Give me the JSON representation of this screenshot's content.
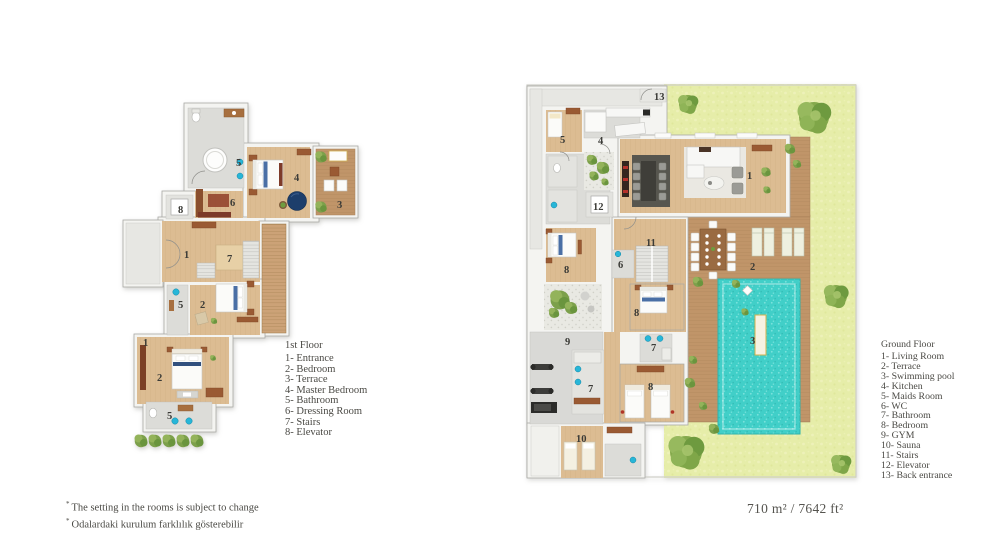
{
  "colors": {
    "grass": "#e6eda9",
    "pool": "#41cfc8",
    "deck": "#c09569",
    "wood": "#dcbc92",
    "tile": "#dcdcd8",
    "wall": "#f4f4f1",
    "wallline": "#a9a9a6",
    "cyan": "#27b6d8",
    "navy": "#1d3e6b",
    "brown": "#9a5a33",
    "dkred": "#8a3f2c",
    "tree": "#7ca04b",
    "text": "#4a4944"
  },
  "left_plan": {
    "title": "1st Floor",
    "legend": [
      "1- Entrance",
      "2- Bedroom",
      "3- Terrace",
      "4- Master Bedroom",
      "5- Bathroom",
      "6- Dressing Room",
      "7- Stairs",
      "8- Elevator"
    ],
    "labels": [
      {
        "t": "5",
        "x": 236,
        "y": 166
      },
      {
        "t": "4",
        "x": 294,
        "y": 181
      },
      {
        "t": "3",
        "x": 337,
        "y": 208
      },
      {
        "t": "8",
        "x": 178,
        "y": 213
      },
      {
        "t": "6",
        "x": 230,
        "y": 206
      },
      {
        "t": "1",
        "x": 184,
        "y": 258
      },
      {
        "t": "7",
        "x": 227,
        "y": 262
      },
      {
        "t": "2",
        "x": 200,
        "y": 308
      },
      {
        "t": "5",
        "x": 178,
        "y": 308
      },
      {
        "t": "1",
        "x": 143,
        "y": 346
      },
      {
        "t": "2",
        "x": 157,
        "y": 381
      },
      {
        "t": "5",
        "x": 167,
        "y": 419
      }
    ]
  },
  "right_plan": {
    "title": "Ground Floor",
    "legend": [
      "1- Living Room",
      "2- Terrace",
      "3- Swimming pool",
      "4- Kitchen",
      "5- Maids Room",
      "6- WC",
      "7- Bathroom",
      "8- Bedroom",
      "9- GYM",
      "10- Sauna",
      "11- Stairs",
      "12- Elevator",
      "13- Back entrance"
    ],
    "labels": [
      {
        "t": "13",
        "x": 654,
        "y": 100
      },
      {
        "t": "5",
        "x": 560,
        "y": 143
      },
      {
        "t": "4",
        "x": 598,
        "y": 144
      },
      {
        "t": "12",
        "x": 593,
        "y": 210
      },
      {
        "t": "1",
        "x": 747,
        "y": 179
      },
      {
        "t": "11",
        "x": 646,
        "y": 246
      },
      {
        "t": "6",
        "x": 618,
        "y": 268
      },
      {
        "t": "8",
        "x": 564,
        "y": 273
      },
      {
        "t": "2",
        "x": 750,
        "y": 270
      },
      {
        "t": "8",
        "x": 634,
        "y": 316
      },
      {
        "t": "3",
        "x": 750,
        "y": 344
      },
      {
        "t": "9",
        "x": 565,
        "y": 345
      },
      {
        "t": "7",
        "x": 651,
        "y": 351
      },
      {
        "t": "8",
        "x": 648,
        "y": 390
      },
      {
        "t": "7",
        "x": 588,
        "y": 392
      },
      {
        "t": "10",
        "x": 576,
        "y": 442
      }
    ]
  },
  "footnotes": [
    {
      "marker": "*",
      "text": "The setting in the rooms is subject to change"
    },
    {
      "marker": "*",
      "text": "Odalardaki kurulum farklılık gösterebilir"
    }
  ],
  "area_label": "710 m² / 7642 ft²"
}
